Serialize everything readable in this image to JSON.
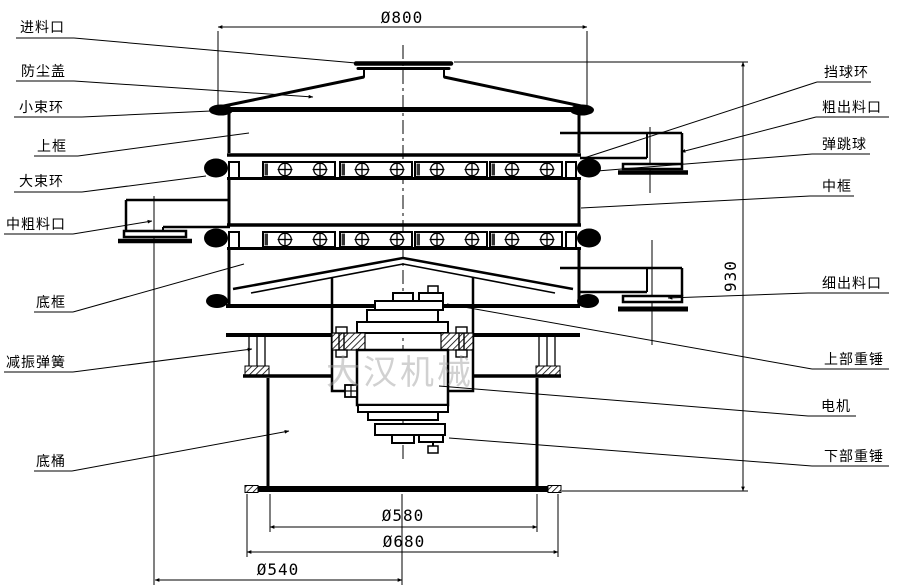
{
  "drawing_title": "旋振筛结构图",
  "watermark_text": "大汉机械",
  "dimensions": {
    "top_width": "Ø800",
    "total_height": "930",
    "barrel_inner": "Ø580",
    "barrel_outer": "Ø680",
    "outlet_offset": "Ø540"
  },
  "labels_left": [
    {
      "id": "feed-inlet",
      "text": "进料口"
    },
    {
      "id": "dust-cover",
      "text": "防尘盖"
    },
    {
      "id": "small-clamp-ring",
      "text": "小束环"
    },
    {
      "id": "upper-frame",
      "text": "上框"
    },
    {
      "id": "big-clamp-ring",
      "text": "大束环"
    },
    {
      "id": "mid-coarse-outlet",
      "text": "中粗料口"
    },
    {
      "id": "bottom-frame",
      "text": "底框"
    },
    {
      "id": "damping-spring",
      "text": "减振弹簧"
    },
    {
      "id": "bottom-barrel",
      "text": "底桶"
    }
  ],
  "labels_right": [
    {
      "id": "ball-stop-ring",
      "text": "挡球环"
    },
    {
      "id": "coarse-outlet",
      "text": "粗出料口"
    },
    {
      "id": "bouncing-ball",
      "text": "弹跳球"
    },
    {
      "id": "middle-frame",
      "text": "中框"
    },
    {
      "id": "fine-outlet",
      "text": "细出料口"
    },
    {
      "id": "upper-weight",
      "text": "上部重锤"
    },
    {
      "id": "motor",
      "text": "电机"
    },
    {
      "id": "lower-weight",
      "text": "下部重锤"
    }
  ]
}
